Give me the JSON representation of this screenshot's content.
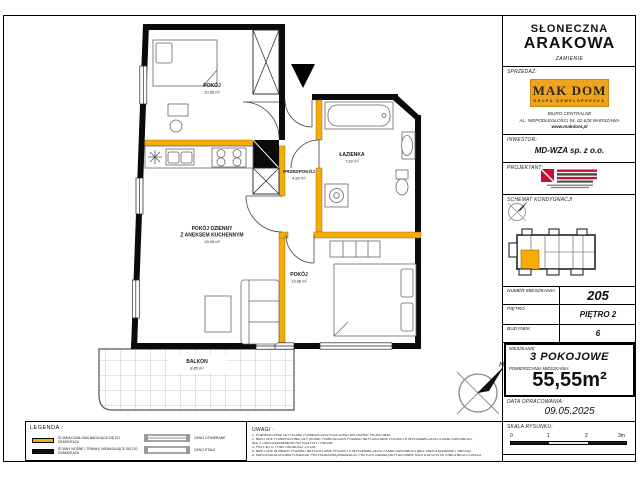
{
  "header": {
    "line1": "SŁONECZNA",
    "line2": "ARAKOWA",
    "line3": "ZAMIENIE"
  },
  "sprzedaz": {
    "label": "SPRZEDAŻ:",
    "brand_main": "MAK DOM",
    "brand_sub": "GRUPA DEWELOPERSKA",
    "addr1": "BIURO CENTRALNE",
    "addr2": "AL. NIEPODLEGŁOŚCI 54, 02-626 WARSZAWA",
    "addr3": "www.makdom.pl"
  },
  "inwestor": {
    "label": "INWESTOR:",
    "value": "MD-WZA sp. z o.o."
  },
  "projektant": {
    "label": "PROJEKTANT:"
  },
  "schemat": {
    "label": "SCHEMAT KONDYGNACJI"
  },
  "details": {
    "rows": [
      {
        "label": "NUMER MIESZKANIA",
        "value": "205"
      },
      {
        "label": "PIĘTRO",
        "value": "PIĘTRO 2"
      },
      {
        "label": "BUDYNEK",
        "value": "6"
      }
    ]
  },
  "mieszkanie": {
    "label": "MIESZKANIE:",
    "type": "3 POKOJOWE",
    "area_label": "POWIERZCHNIA MIESZKANIA:",
    "area": "55,55m²"
  },
  "data_row": {
    "label": "DATA OPRACOWANIA:",
    "value": "09.05.2025"
  },
  "skala": {
    "label": "SKALA RYSUNKU:",
    "ticks": [
      "0",
      "1",
      "2",
      "3m"
    ]
  },
  "compass": {
    "north": "N"
  },
  "legend": {
    "title": "LEGENDA :",
    "items": [
      {
        "label": "ŚCIANA DZIAŁOWA NADAJĄCA SIĘ DO DEMONTAŻU"
      },
      {
        "label": "ŚCIANY NOŚNE I TRWAŁE NIENADAJĄCE SIĘ DO DEMONTAŻU"
      }
    ],
    "windows": [
      {
        "label": "OKNO OTWIERANE"
      },
      {
        "label": "OKNO STAŁE"
      }
    ]
  },
  "uwagi": {
    "title": "UWAGI :",
    "lines": [
      "1. POWIERZCHNIE UŻYTKOWE POMIESZCZEŃ POLICZONO WG NORMY  PN-ISO 9836.",
      "2. NIEKTÓRE POWIERZCHNIE UŻYTKOWE POMIESZCZEŃ PODANO NA PODSTAWIE PROJEKTU WYKONAWCZEGO STANU SUROWEGO,",
      "    ALE Z UWZGLĘDNIENIEM PRZYSZŁYCH TYNKÓW.",
      "3. PRZYJĘTO TYNKI GRUBOŚCI 1,5 CM.",
      "4. NIEKTÓRE WYMIARY PODANO NA PODSTAWIE PROJEKTU WYKONAWCZEGO STANU SUROWEGO (BEZ UWZGLĘDNIENIA TYNKÓW).",
      "5. KARTA KATALOGOWA POKAZUJE PRZYKŁADOWĄ ARANŻACJĘ PRZYGOTOWANĄ NA PODSTAWIE RZUTU ARCHITEKTONICZNEGO LOKALU."
    ]
  },
  "plan": {
    "rooms": [
      {
        "name": "POKÓJ",
        "area": "10,36 m²"
      },
      {
        "name": "ŁAZIENKA",
        "area": "7,52 m²"
      },
      {
        "name": "PRZEDPOKÓJ",
        "area": "4,82 m²"
      },
      {
        "name1": "POKÓJ DZIENNY",
        "name2": "Z ANEKSEM KUCHENNYM",
        "area": "19,49 m²"
      },
      {
        "name": "POKÓJ",
        "area": "13,36 m²"
      },
      {
        "name": "BALKON",
        "area": "8,85 m²"
      }
    ]
  },
  "colors": {
    "partition_yellow": "#f7ac08",
    "logo_yellow": "#efa41e",
    "wall_black": "#0b0b0b"
  }
}
